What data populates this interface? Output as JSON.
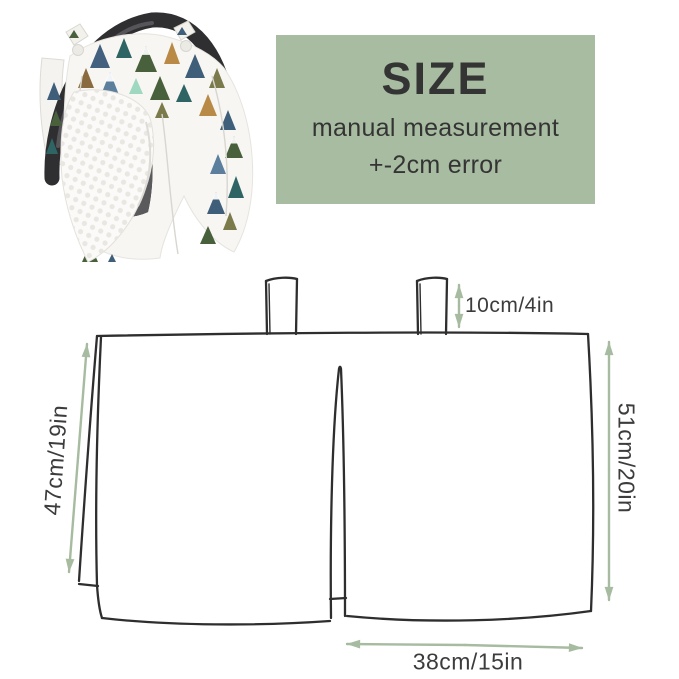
{
  "size_panel": {
    "title": "SIZE",
    "line1": "manual measurement",
    "line2": "+-2cm error"
  },
  "diagram": {
    "tab_height_label": "10cm/4in",
    "left_height_label": "47cm/19in",
    "right_height_label": "51cm/20in",
    "bottom_width_label": "38cm/15in"
  },
  "colors": {
    "panel_bg": "#a8bca1",
    "panel_text": "#343434",
    "diagram_line": "#2e2e2e",
    "dimension_arrow": "#a6bb9f",
    "label_text": "#3c3c3c",
    "handle": "#2f2f31",
    "seat": "#5a5a5d",
    "canopy_fabric": "#f7f6f2",
    "minky_fabric": "#fbfaf8"
  }
}
